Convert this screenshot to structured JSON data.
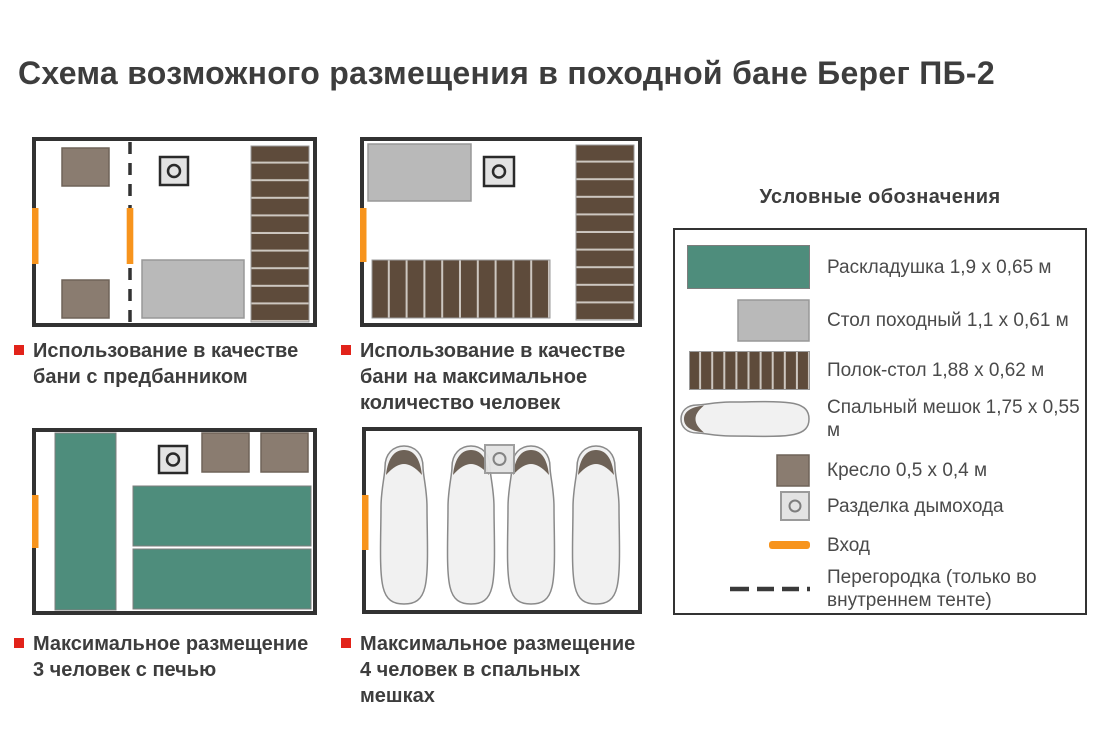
{
  "title": "Схема возможного размещения в походной бане Берег ПБ-2",
  "colors": {
    "text": "#3d3d3d",
    "legend-text": "#4a4a4a",
    "red": "#e2231a",
    "orange": "#f7941d",
    "teal": "#4e8d7c",
    "table-gray": "#b9b9b9",
    "plank-brown": "#5e4b3b",
    "plank-gap": "#cdc7c0",
    "armchair": "#8a7c70",
    "frame": "#323232",
    "chimney-fill": "#e3e3e3",
    "bag-fill": "#f1f1f1",
    "bag-outline": "#8a8a8a",
    "hood": "#6e6257"
  },
  "diagrams": [
    {
      "caption": "Использование в качестве\nбани с предбанником"
    },
    {
      "caption": "Использование в качестве\nбани на максимальное\nколичество человек"
    },
    {
      "caption": "Максимальное размещение\n3 человек с печью"
    },
    {
      "caption": "Максимальное размещение\n4 человек в спальных мешках"
    }
  ],
  "legend": {
    "title": "Условные обозначения",
    "items": [
      {
        "icon": "cot-swatch",
        "label": "Раскладушка 1,9 х 0,65 м"
      },
      {
        "icon": "camp-table-swatch",
        "label": "Стол походный 1,1 х 0,61 м"
      },
      {
        "icon": "plank-table-swatch",
        "label": "Полок-стол 1,88 х 0,62 м"
      },
      {
        "icon": "sleeping-bag-icon",
        "label": "Спальный мешок 1,75 х 0,55 м"
      },
      {
        "icon": "armchair-swatch",
        "label": "Кресло 0,5 х 0,4 м"
      },
      {
        "icon": "chimney-outlet-icon",
        "label": "Разделка дымохода"
      },
      {
        "icon": "entrance-line",
        "label": "Вход"
      },
      {
        "icon": "partition-line",
        "label": "Перегородка (только во\nвнутреннем тенте)"
      }
    ]
  }
}
